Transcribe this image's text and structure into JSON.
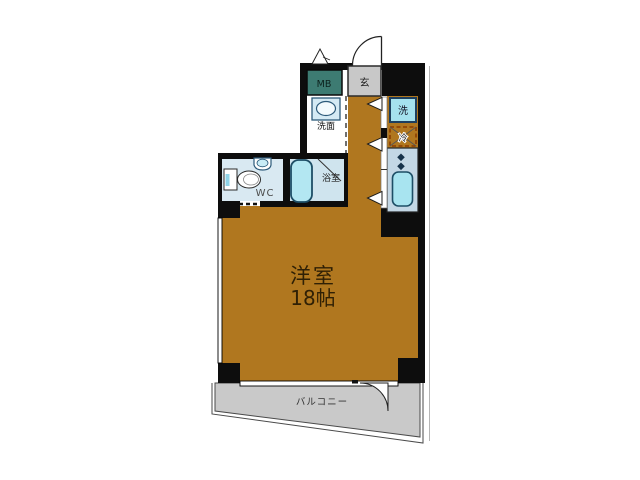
{
  "floorplan": {
    "labels": {
      "meter_box": "MB",
      "entrance": "玄",
      "washstand": "洗面",
      "toilet_room": "WC",
      "bathroom": "浴室",
      "washing_machine": "洗",
      "refrigerator": "冷",
      "balcony": "バルコニー"
    },
    "main_room": {
      "name": "洋室",
      "size": "18帖"
    },
    "colors": {
      "wall": "#0d0d0d",
      "room_floor": "#b0771f",
      "balcony_floor": "#c9c9c9",
      "entrance_floor": "#c8c8c8",
      "meter_box": "#3d7b72",
      "wc_floor": "#d9e9f2",
      "bath_floor": "#cfe4ee",
      "counter": "#c3d7e5",
      "kitchen_sink": "#a8e4f0",
      "bathtub": "#b3e7f2",
      "washer_box": "#a5e2ee",
      "washbasin_box": "#d4eaf4",
      "fridge_dash": "#8a3c00",
      "room_text": "#2f2005"
    }
  }
}
